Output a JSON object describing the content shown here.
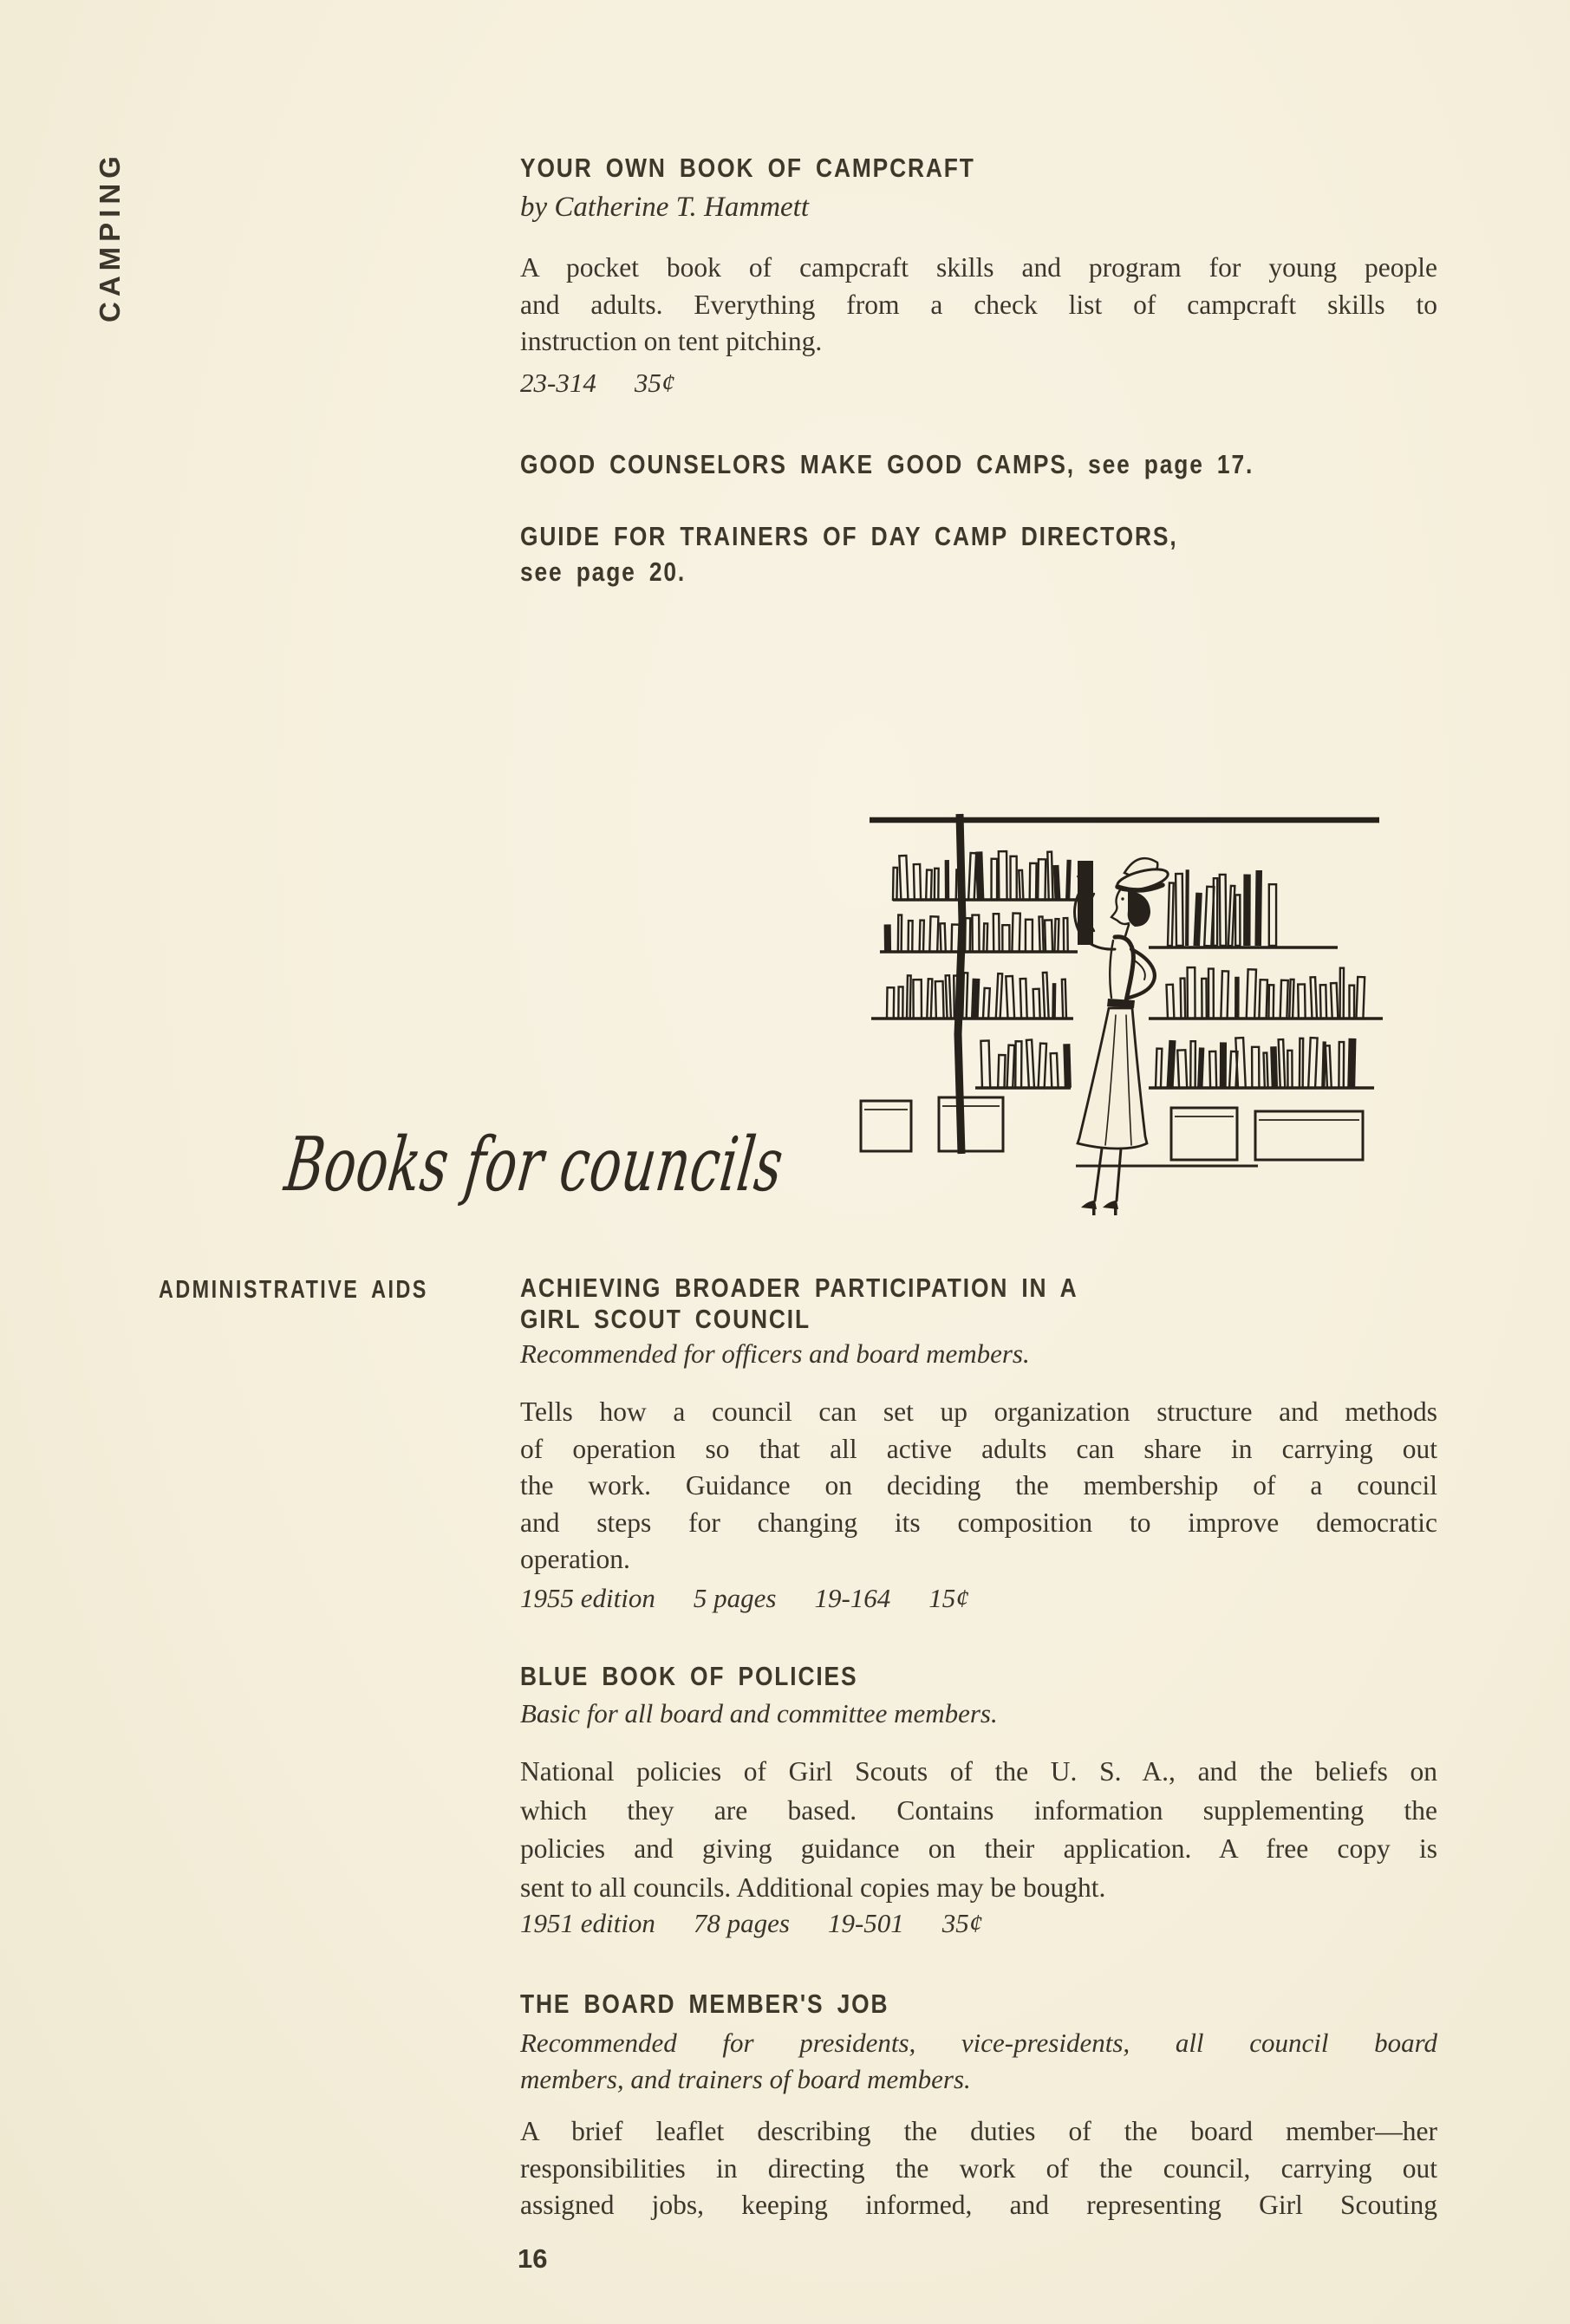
{
  "page": {
    "number": "16"
  },
  "sidebar": {
    "label": "CAMPING"
  },
  "campcraft": {
    "title": "YOUR OWN BOOK OF CAMPCRAFT",
    "byline": "by Catherine T. Hammett",
    "body_lines": [
      "A pocket book of campcraft skills and program for young people",
      "and adults. Everything from a check list of campcraft skills to",
      "instruction on tent pitching."
    ],
    "meta": [
      "23-314",
      "35¢"
    ]
  },
  "cross_refs": {
    "good_counselors": "GOOD COUNSELORS MAKE GOOD CAMPS, see page 17.",
    "guide_trainers_lines": [
      "GUIDE FOR TRAINERS OF DAY CAMP DIRECTORS,",
      "see page 20."
    ]
  },
  "illustration": {
    "description": "woman-browsing-library-bookshelves"
  },
  "councils_section": {
    "script_heading": "Books for councils",
    "category_label": "ADMINISTRATIVE AIDS"
  },
  "achieving": {
    "title_lines": [
      "ACHIEVING BROADER PARTICIPATION IN A",
      "GIRL SCOUT COUNCIL"
    ],
    "audience": "Recommended for officers and board members.",
    "body_lines": [
      "Tells how a council can set up organization structure and methods",
      "of operation so that all active adults can share in carrying out",
      "the work. Guidance on deciding the membership of a council",
      "and steps for changing its composition to improve democratic",
      "operation."
    ],
    "meta": [
      "1955 edition",
      "5 pages",
      "19-164",
      "15¢"
    ]
  },
  "blue_book": {
    "title": "BLUE BOOK OF POLICIES",
    "audience": "Basic for all board and committee members.",
    "body_lines": [
      "National policies of Girl Scouts of the U. S. A., and the beliefs on",
      "which they are based. Contains information supplementing the",
      "policies and giving guidance on their application. A free copy is",
      "sent to all councils. Additional copies may be bought."
    ],
    "meta": [
      "1951 edition",
      "78 pages",
      "19-501",
      "35¢"
    ]
  },
  "board_job": {
    "title": "THE BOARD MEMBER'S JOB",
    "audience_lines": [
      "Recommended for presidents, vice-presidents, all council board",
      "members, and trainers of board members."
    ],
    "body_lines": [
      "A brief leaflet describing the duties of the board member—her",
      "responsibilities in directing the work of the council, carrying out",
      "assigned jobs, keeping informed, and representing Girl Scouting"
    ]
  }
}
